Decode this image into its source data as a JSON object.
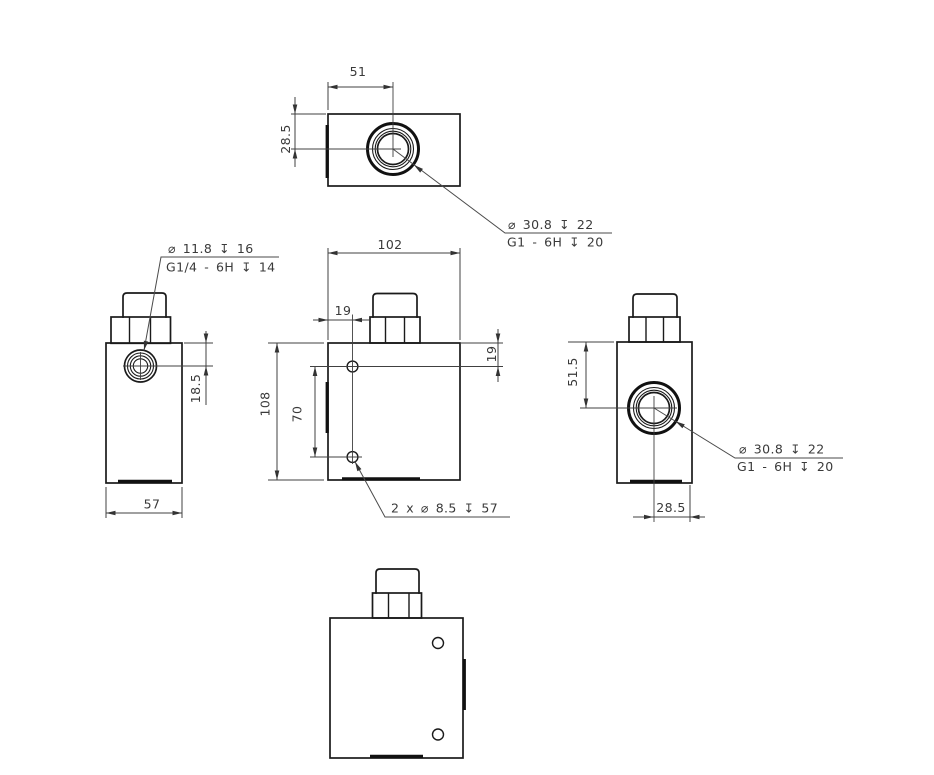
{
  "colors": {
    "background": "#ffffff",
    "object_line": "#1a1a1a",
    "dimension_line": "#404040"
  },
  "views": {
    "top": {
      "dim_port_x": "51",
      "dim_port_y": "28.5",
      "callout": {
        "line1": "⌀ 30.8 ↧ 22",
        "line2": "G1 - 6H ↧ 20"
      }
    },
    "left_side": {
      "callout": {
        "line1": "⌀ 11.8 ↧ 16",
        "line2": "G1/4 - 6H ↧ 14"
      },
      "dim_port_depth": "18.5",
      "dim_width": "57"
    },
    "front": {
      "dim_width": "102",
      "dim_hole_offset_x": "19",
      "dim_hole_offset_y": "19",
      "dim_height": "108",
      "dim_hole_spacing": "70",
      "callout": {
        "line1": "2 x ⌀ 8.5 ↧ 57"
      }
    },
    "right_side": {
      "dim_port_y": "51.5",
      "dim_port_x": "28.5",
      "callout": {
        "line1": "⌀ 30.8 ↧ 22",
        "line2": "G1 - 6H ↧ 20"
      }
    }
  }
}
